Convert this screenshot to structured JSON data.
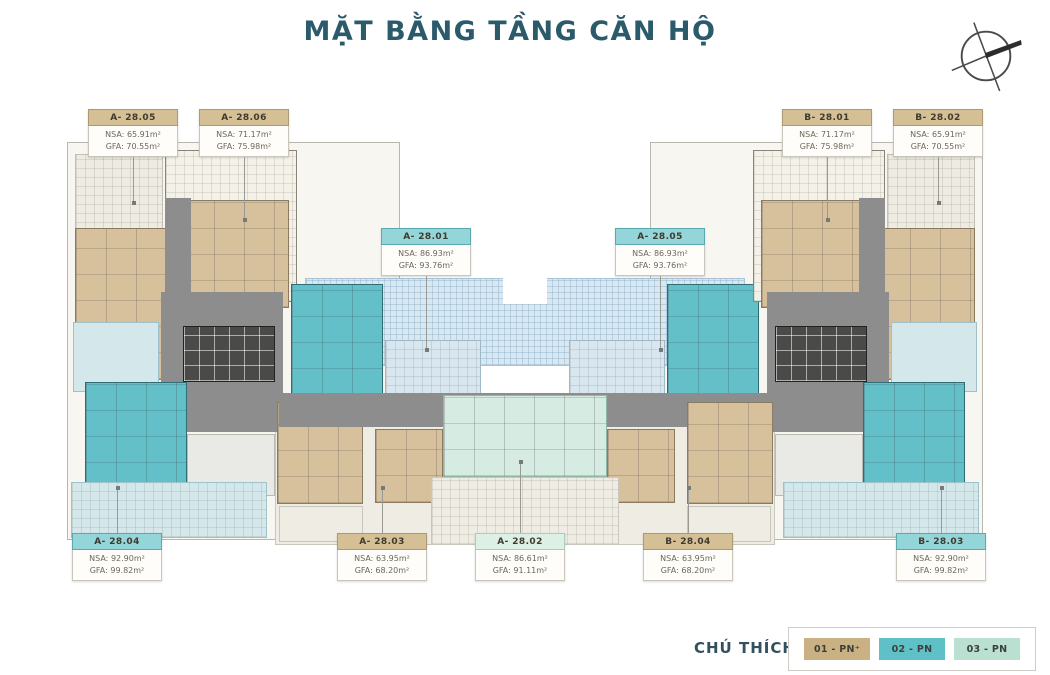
{
  "page": {
    "title": "MẶT BẰNG TẦNG CĂN HỘ"
  },
  "labels": {
    "nsa": "NSA:",
    "gfa": "GFA:"
  },
  "units": [
    {
      "code": "A- 28.05",
      "type": "01-PN",
      "nsa": "65.91m²",
      "gfa": "70.55m²"
    },
    {
      "code": "A- 28.06",
      "type": "01-PN",
      "nsa": "71.17m²",
      "gfa": "75.98m²"
    },
    {
      "code": "B- 28.01",
      "type": "01-PN",
      "nsa": "71.17m²",
      "gfa": "75.98m²"
    },
    {
      "code": "B- 28.02",
      "type": "01-PN",
      "nsa": "65.91m²",
      "gfa": "70.55m²"
    },
    {
      "code": "A- 28.01",
      "type": "02-PN",
      "nsa": "86.93m²",
      "gfa": "93.76m²"
    },
    {
      "code": "A- 28.05",
      "type": "02-PN",
      "nsa": "86.93m²",
      "gfa": "93.76m²"
    },
    {
      "code": "A- 28.04",
      "type": "02-PN",
      "nsa": "92.90m²",
      "gfa": "99.82m²"
    },
    {
      "code": "A- 28.03",
      "type": "01-PN",
      "nsa": "63.95m²",
      "gfa": "68.20m²"
    },
    {
      "code": "A- 28.02",
      "type": "03-PN",
      "nsa": "86.61m²",
      "gfa": "91.11m²"
    },
    {
      "code": "B- 28.04",
      "type": "01-PN",
      "nsa": "63.95m²",
      "gfa": "68.20m²"
    },
    {
      "code": "B- 28.03",
      "type": "02-PN",
      "nsa": "92.90m²",
      "gfa": "99.82m²"
    }
  ],
  "legend": {
    "title": "CHÚ THÍCH",
    "items": [
      {
        "label": "01 - PN⁺",
        "color": "#c9b183"
      },
      {
        "label": "02 - PN",
        "color": "#5fc0c8"
      },
      {
        "label": "03 - PN",
        "color": "#b9e0d0"
      }
    ]
  },
  "colors": {
    "title_text": "#2b5a6b",
    "unit_tan": "#d7c19c",
    "unit_teal": "#63c0c9",
    "unit_mint": "#d6ebe2",
    "corridor_gray": "#8d8d8d",
    "core_dark": "#4a4a48",
    "glass_blue": "#d7e8f3",
    "aqua_floor": "#d4e8ec",
    "terrace_beige": "#f1efe7"
  }
}
